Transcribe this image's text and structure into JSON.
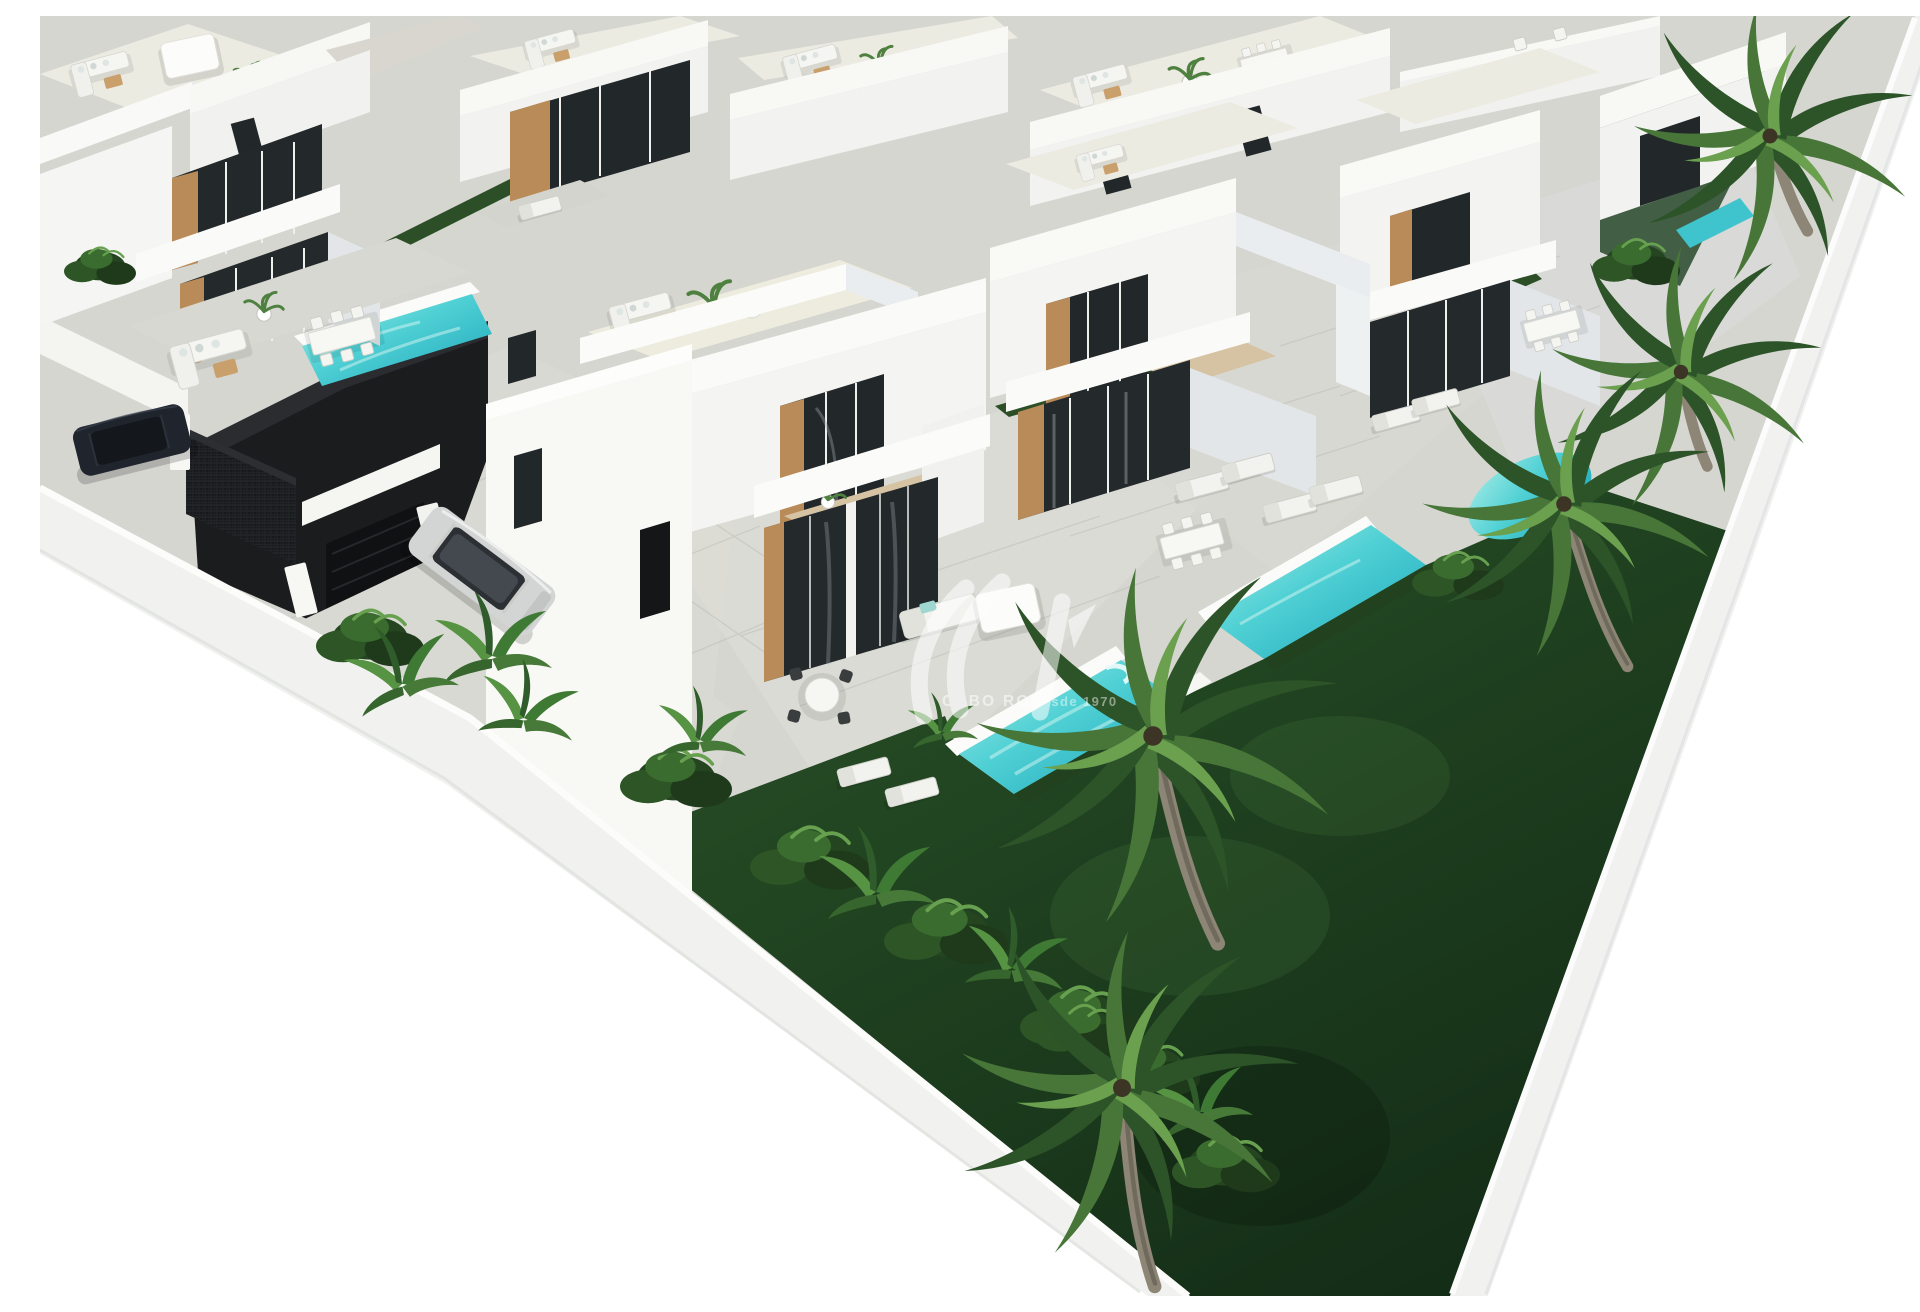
{
  "image": {
    "alt": "Aerial 3D architectural render of a modern development of white two-storey villas with rooftop terraces, private turquoise pools, grey paved terraces, dark green lawns, tropical shrubs and a row of palm trees along a white boundary wall; a dark SUV and a silver SUV are parked by the entrance gates",
    "background": "#ffffff",
    "width_px": 1920,
    "height_px": 1280
  },
  "watermark": {
    "logo_monogram": "SIV",
    "brand": "CABO ROIG",
    "tagline": "Desde 1970",
    "text_color": "#ffffff"
  },
  "palette": {
    "pool_water": "#2db9c7",
    "pool_water_light": "#9fe9e2",
    "lawn_dark": "#16301a",
    "lawn_mid": "#2a5428",
    "palm_frond": "#3f6f33",
    "palm_trunk": "#8d8575",
    "paving": "#d6d6d1",
    "paving_light": "#dfdfd9",
    "facade_white": "#f6f6f3",
    "facade_shade": "#e2e6e8",
    "roof_terrace": "#edecdf",
    "balcony_tile": "#d6c3a4",
    "glass_dark": "#22272a",
    "wood_accent": "#b98b58",
    "gate_black": "#17191b",
    "asphalt": "#1a1c1e",
    "car_dark": "#20242c",
    "car_silver": "#d3d5d4",
    "boundary_wall": "#f1f2ef"
  },
  "scene": {
    "setting": "gated residential villa development seen from above at an angle, bounded by two white walls converging toward the lower right, pure white background outside the site",
    "villas_front_row": 4,
    "villas_back_row": 5,
    "pools_visible": 6,
    "palm_trees": 5,
    "shrub_clusters": 10,
    "cars": [
      "dark SUV parked by black entrance gate",
      "silver SUV parked on driveway"
    ],
    "furniture": [
      "lounge sofa sets",
      "rectangular dining tables with chairs",
      "round dining set",
      "sun loungers",
      "white canopies"
    ]
  }
}
